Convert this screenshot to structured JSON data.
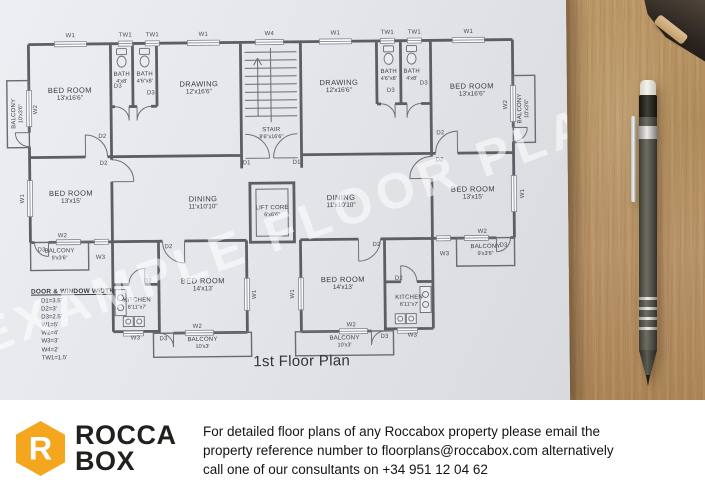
{
  "colors": {
    "brand_orange": "#F5A61F",
    "paper": "#e7e8eb",
    "wood": "#b48e5f"
  },
  "plan": {
    "title": "1st Floor Plan",
    "watermark": "EXAMPLE FLOOR PLAN",
    "rooms": [
      {
        "name": "BED ROOM",
        "size": "13'x16'6\"",
        "x": 71,
        "y": 92
      },
      {
        "name": "BATH",
        "size": "4'x8'",
        "x": 123,
        "y": 77,
        "small": true
      },
      {
        "name": "BATH",
        "size": "4'6\"x8'",
        "x": 146,
        "y": 77,
        "small": true
      },
      {
        "name": "DRAWING",
        "size": "12'x16'6\"",
        "x": 200,
        "y": 87
      },
      {
        "name": "STAIR",
        "size": "8'6\"x16'6\"",
        "x": 272,
        "y": 134,
        "small": true
      },
      {
        "name": "DRAWING",
        "size": "12'x16'6\"",
        "x": 340,
        "y": 87
      },
      {
        "name": "BATH",
        "size": "4'6\"x8'",
        "x": 390,
        "y": 77,
        "small": true
      },
      {
        "name": "BATH",
        "size": "4'x8'",
        "x": 413,
        "y": 77,
        "small": true
      },
      {
        "name": "BED ROOM",
        "size": "13'x16'6\"",
        "x": 473,
        "y": 92
      },
      {
        "name": "BALCONY",
        "size": "10'x3'6\"",
        "x": 19,
        "y": 111,
        "vertical": true,
        "small": true
      },
      {
        "name": "BALCONY",
        "size": "10'x3'6\"",
        "x": 525,
        "y": 111,
        "vertical": true,
        "small": true
      },
      {
        "name": "BED ROOM",
        "size": "13'x15'",
        "x": 71,
        "y": 195
      },
      {
        "name": "DINING",
        "size": "11'x10'10\"",
        "x": 203,
        "y": 202
      },
      {
        "name": "LIFT CORE",
        "size": "6'x6'6\"",
        "x": 272,
        "y": 212,
        "small": true
      },
      {
        "name": "DINING",
        "size": "11'x10'10\"",
        "x": 341,
        "y": 202
      },
      {
        "name": "BED ROOM",
        "size": "13'x15'",
        "x": 473,
        "y": 195
      },
      {
        "name": "BALCONY",
        "size": "9'x3'6\"",
        "x": 59,
        "y": 253,
        "small": true
      },
      {
        "name": "BALCONY",
        "size": "9'x3'6\"",
        "x": 485,
        "y": 253,
        "small": true
      },
      {
        "name": "KITCHEN",
        "size": "6'11\"x7'",
        "x": 136,
        "y": 303,
        "small": true
      },
      {
        "name": "BED ROOM",
        "size": "14'x13'",
        "x": 202,
        "y": 284
      },
      {
        "name": "BED ROOM",
        "size": "14'x13'",
        "x": 342,
        "y": 284
      },
      {
        "name": "KITCHEN",
        "size": "6'11\"x7'",
        "x": 408,
        "y": 303,
        "small": true
      },
      {
        "name": "BALCONY",
        "size": "10'x3'",
        "x": 201,
        "y": 343,
        "small": true
      },
      {
        "name": "BALCONY",
        "size": "10'x3'",
        "x": 343,
        "y": 343,
        "small": true
      }
    ],
    "marks": [
      {
        "t": "W1",
        "x": 72,
        "y": 34
      },
      {
        "t": "TW1",
        "x": 127,
        "y": 34
      },
      {
        "t": "TW1",
        "x": 154,
        "y": 34
      },
      {
        "t": "W1",
        "x": 205,
        "y": 34
      },
      {
        "t": "W4",
        "x": 271,
        "y": 34
      },
      {
        "t": "W1",
        "x": 337,
        "y": 34
      },
      {
        "t": "TW1",
        "x": 389,
        "y": 34
      },
      {
        "t": "TW1",
        "x": 416,
        "y": 34
      },
      {
        "t": "W1",
        "x": 470,
        "y": 34
      },
      {
        "t": "W2",
        "x": 37,
        "y": 107,
        "v": true
      },
      {
        "t": "W1",
        "x": 23,
        "y": 196,
        "v": true
      },
      {
        "t": "W2",
        "x": 507,
        "y": 107,
        "v": true
      },
      {
        "t": "W1",
        "x": 523,
        "y": 196,
        "v": true
      },
      {
        "t": "D2",
        "x": 103,
        "y": 135
      },
      {
        "t": "D2",
        "x": 441,
        "y": 135
      },
      {
        "t": "D3",
        "x": 119,
        "y": 85
      },
      {
        "t": "D3",
        "x": 152,
        "y": 92
      },
      {
        "t": "D3",
        "x": 425,
        "y": 85
      },
      {
        "t": "D3",
        "x": 392,
        "y": 92
      },
      {
        "t": "D1",
        "x": 247,
        "y": 163
      },
      {
        "t": "D1",
        "x": 297,
        "y": 163
      },
      {
        "t": "D2",
        "x": 104,
        "y": 162
      },
      {
        "t": "D2",
        "x": 440,
        "y": 162
      },
      {
        "t": "W2",
        "x": 62,
        "y": 234
      },
      {
        "t": "D3",
        "x": 41,
        "y": 248
      },
      {
        "t": "W3",
        "x": 100,
        "y": 256
      },
      {
        "t": "W2",
        "x": 482,
        "y": 234
      },
      {
        "t": "D3",
        "x": 503,
        "y": 248
      },
      {
        "t": "W3",
        "x": 444,
        "y": 256
      },
      {
        "t": "D2",
        "x": 168,
        "y": 246
      },
      {
        "t": "D2",
        "x": 376,
        "y": 246
      },
      {
        "t": "W1",
        "x": 254,
        "y": 294,
        "v": true
      },
      {
        "t": "W1",
        "x": 292,
        "y": 294,
        "v": true
      },
      {
        "t": "W2",
        "x": 196,
        "y": 326
      },
      {
        "t": "W2",
        "x": 350,
        "y": 326
      },
      {
        "t": "D3",
        "x": 162,
        "y": 338
      },
      {
        "t": "D3",
        "x": 383,
        "y": 338
      },
      {
        "t": "D2",
        "x": 147,
        "y": 280
      },
      {
        "t": "D2",
        "x": 398,
        "y": 280
      },
      {
        "t": "W3",
        "x": 134,
        "y": 337
      },
      {
        "t": "W3",
        "x": 411,
        "y": 337
      }
    ],
    "legend": {
      "title": "DOOR & WINDOW WIDTH",
      "items": [
        "D1=3.5'",
        "D2=3'",
        "D3=2.5'",
        "W1=5'",
        "W2=4'",
        "W3=3'",
        "W4=2'",
        "TW1=1.5'"
      ]
    }
  },
  "footer": {
    "brand": {
      "line1": "ROCCA",
      "line2": "BOX"
    },
    "contact_line1": "For detailed floor plans of any Roccabox property please email the",
    "contact_line2": "property reference number to floorplans@roccabox.com alternatively",
    "contact_line3": "call one of our consultants on +34 951 12 04 62"
  }
}
